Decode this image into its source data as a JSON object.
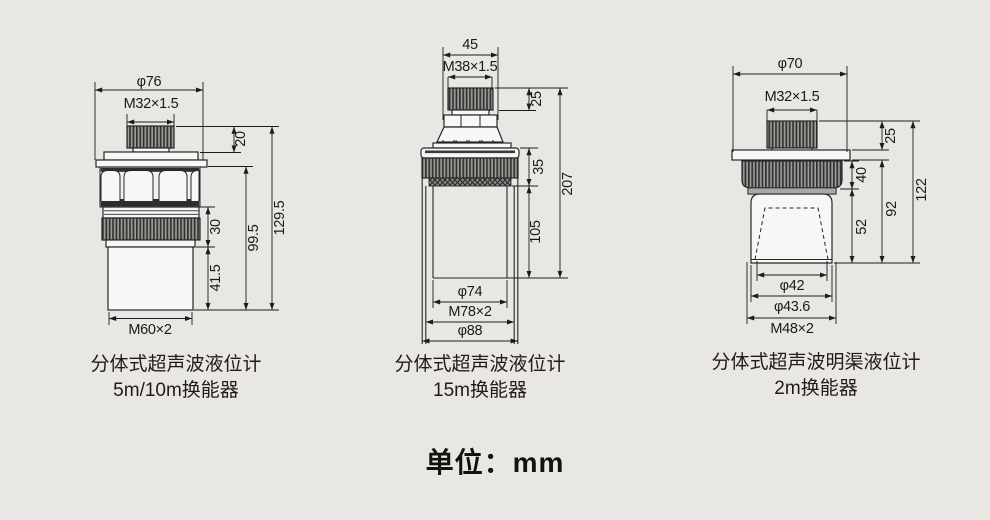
{
  "page": {
    "unit_label": "单位：mm",
    "background_color": "#e9e7e4",
    "line_color": "#1c1c1c"
  },
  "sensors": [
    {
      "caption_line1": "分体式超声波液位计",
      "caption_line2": "5m/10m换能器",
      "dims": {
        "flange_diameter": "φ76",
        "top_thread": "M32×1.5",
        "cap_height": "20",
        "ring_height": "30",
        "tip_height": "41.5",
        "lower_height": "99.5",
        "total_height": "129.5",
        "body_thread": "M60×2"
      }
    },
    {
      "caption_line1": "分体式超声波液位计",
      "caption_line2": "15m换能器",
      "dims": {
        "top_width": "45",
        "top_thread": "M38×1.5",
        "cap_height": "25",
        "ring_height": "35",
        "bore_depth": "105",
        "total_height": "207",
        "inner_diameter": "φ74",
        "body_thread": "M78×2",
        "outer_diameter": "φ88"
      }
    },
    {
      "caption_line1": "分体式超声波明渠液位计",
      "caption_line2": "2m换能器",
      "dims": {
        "flange_diameter": "φ70",
        "top_thread": "M32×1.5",
        "cap_height": "25",
        "ring_height": "40",
        "horn_height": "52",
        "lower_height": "92",
        "total_height": "122",
        "horn_diameter": "φ42",
        "tip_diameter": "φ43.6",
        "body_thread": "M48×2"
      }
    }
  ]
}
